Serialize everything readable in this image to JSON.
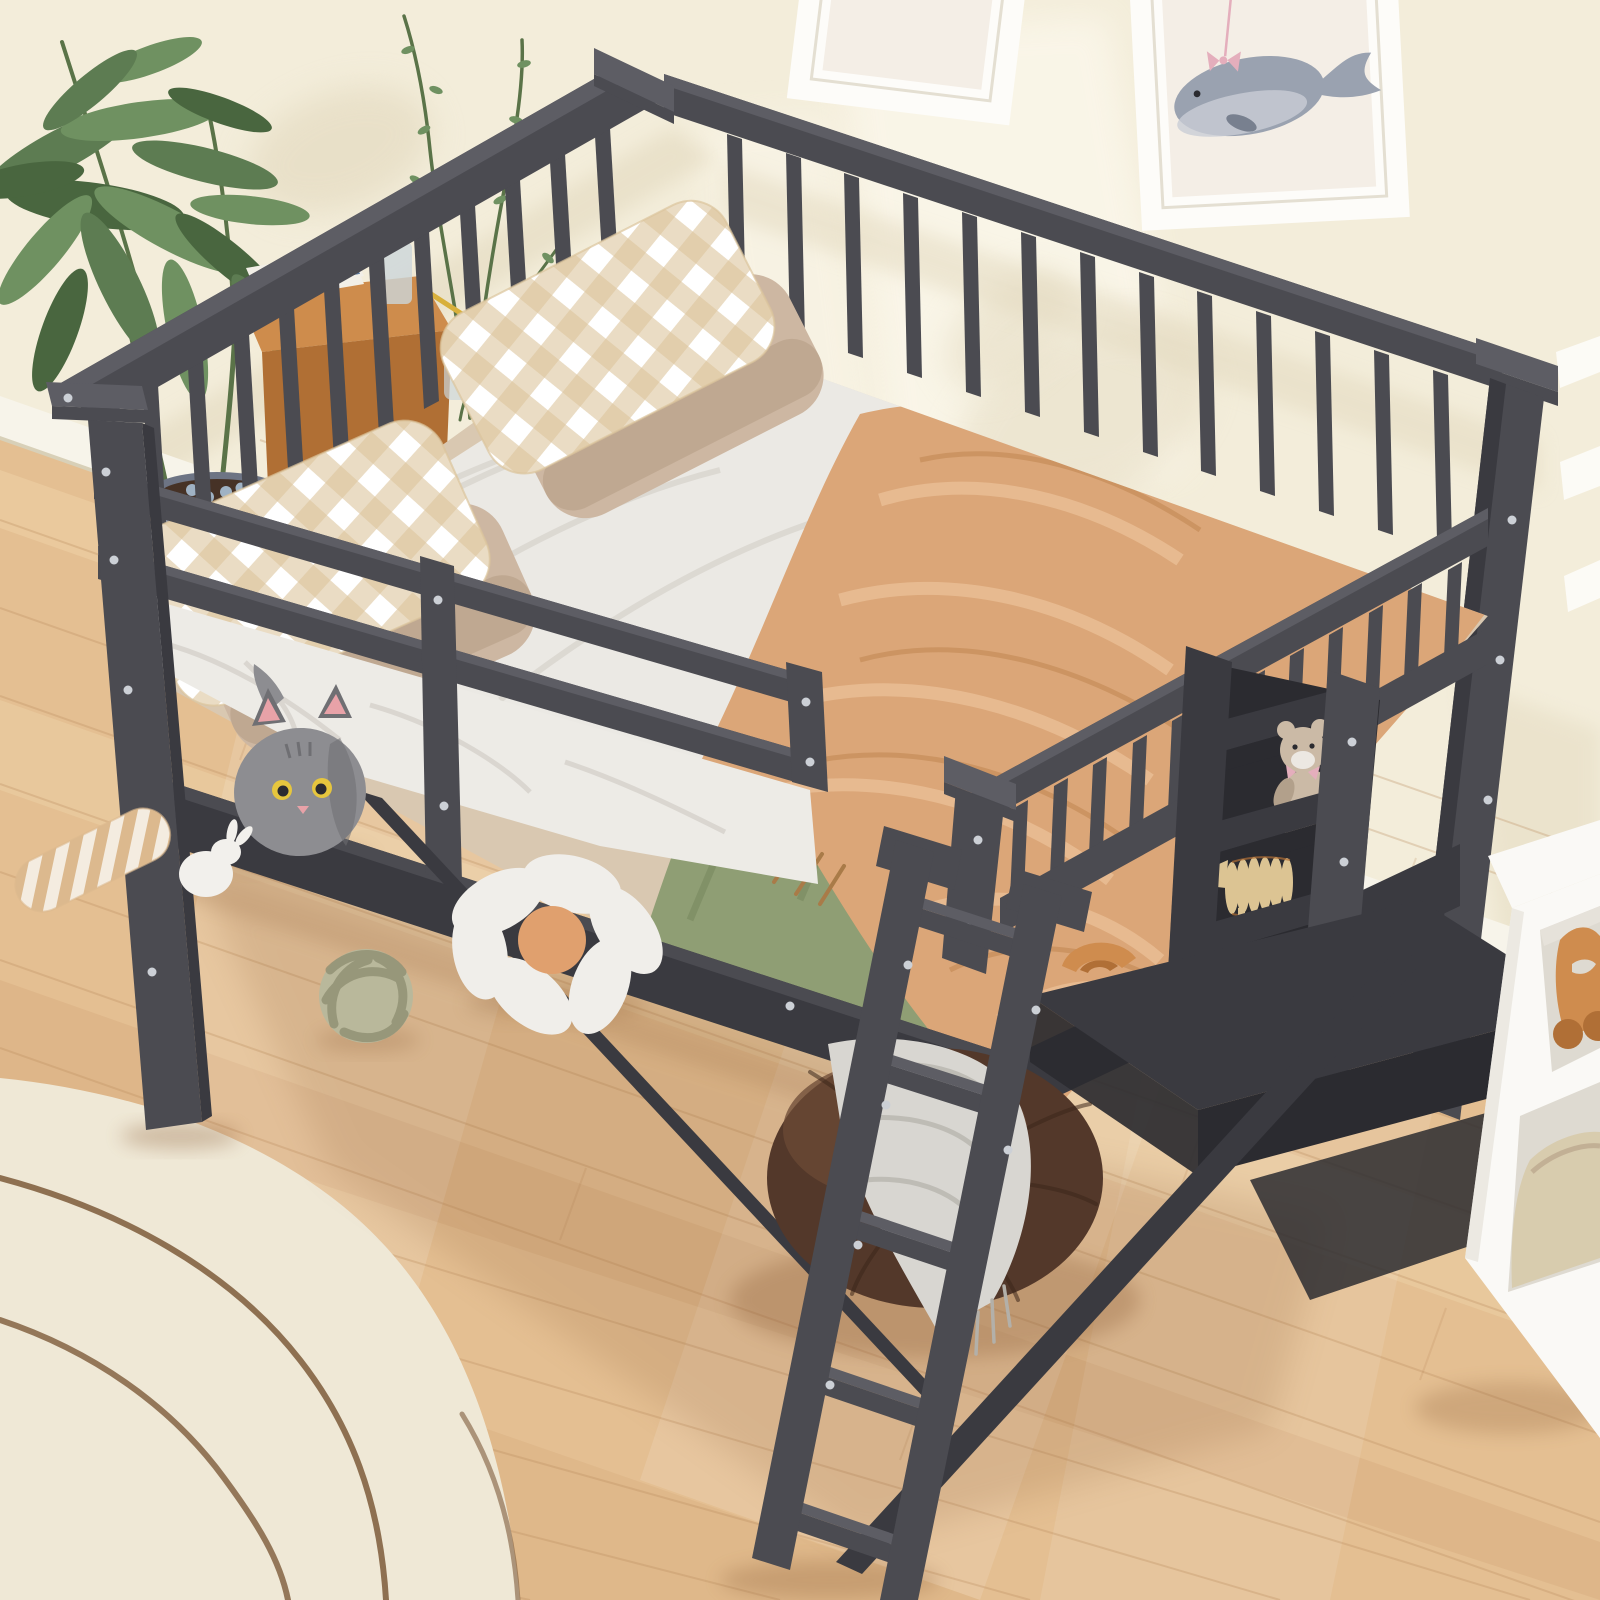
{
  "meta": {
    "title": "Product photo: gray wooden full-size loft bed with storage shelves, desk and ladder in a child's bedroom"
  },
  "palette": {
    "wall": "#f3edda",
    "wall_shadow": "#e2d8bd",
    "wall_light": "#fcf8ec",
    "baseboard": "#f7f4ea",
    "baseboard_shadow": "#d8d0b8",
    "floor": "#e4bf92",
    "floor_light": "#f2d9af",
    "floor_dark": "#cfa273",
    "floor_seam": "#b98a5c",
    "floor_shadow": "#8a5c34",
    "rug": "#efe8d6",
    "rug_line": "#7d5a3a",
    "frame_white": "#fdfcf9",
    "frame_shadow": "#e4dfd2",
    "frame_mat": "#f4eee6",
    "whale_gray": "#9aa2b0",
    "whale_dark": "#78808f",
    "whale_belly": "#c9cdd6",
    "bow_pink": "#e4aebc",
    "leaf_a": "#5d7c52",
    "leaf_b": "#6f9161",
    "leaf_c": "#49663f",
    "stem": "#5a7348",
    "pot": "#8b93a4",
    "pot_dark": "#6d7484",
    "soil": "#463226",
    "pebble": "#9fb2c4",
    "nightstand": "#ce8c4c",
    "nightstand_dark": "#b06f34",
    "book_white": "#f2efe7",
    "book_blue": "#5a7aa0",
    "glass": "#ccd6da",
    "pencil_yellow": "#d8b03c",
    "bed_mid": "#4b4b51",
    "bed_light": "#5d5d64",
    "bed_dark": "#3a3a40",
    "bed_darker": "#2b2b30",
    "screw": "#ccd0d6",
    "mattress_white": "#edebe6",
    "mattress_shadow": "#d5d1cb",
    "sheet_beige": "#d9c8b1",
    "sheet_white": "#ebe9e4",
    "green_sheet": "#8f9e74",
    "green_dark": "#77865d",
    "blanket": "#dba678",
    "blanket_light": "#eec49c",
    "blanket_dark": "#c28954",
    "fringe_brown": "#a97b48",
    "gingham_beige": "#dcc49c",
    "stripe_beige": "#dcb98e",
    "pillow_beige": "#cdb7a2",
    "pillow_beige_dark": "#b49c84",
    "cat_gray": "#8d8d91",
    "cat_dark": "#6f6f73",
    "cat_pink": "#e8a2a8",
    "cat_eye": "#e6c63e",
    "toy_white": "#f2f0ec",
    "knot": "#b9b89b",
    "knot_dark": "#8f8e72",
    "flower_white": "#f0eeea",
    "flower_center": "#e0a06e",
    "pouf": "#53382a",
    "pouf_light": "#6b4a36",
    "pouf_dark": "#3c2719",
    "throw": "#d8d6d1",
    "throw_dark": "#b3b0a9",
    "cube_white": "#faf9f6",
    "cube_shadow": "#e6e2da",
    "cube_open": "#dedad1",
    "wood_toy": "#cf8c4e",
    "wood_toy_dark": "#b06f36",
    "basket": "#d8ccae",
    "teddy": "#cbbaa6",
    "teddy_dark": "#b2a08b",
    "sheep_wood": "#dcc493"
  },
  "objects": {
    "scene": "Children's bedroom with a dark gray wooden full-size loft bed with guardrails, under-bed shelves, desk and ladder",
    "wall": "Cream painted wall with soft window light",
    "baseboard": "White baseboard trim",
    "wood_floor": "Light oak plank floor",
    "area_rug": "Cream area rug with brown wavy line pattern",
    "wall_art_left": "White picture frame, partially cropped at top of image",
    "wall_art_whale": "White framed watercolor whale print with pink bow",
    "wall_slats": "White wall trim pieces behind right bed post",
    "plant": "Tall potted green plant in blue-gray ceramic pot",
    "branches": "Decorative green sprig branches behind the head guardrail",
    "nightstand": "Small wooden nightstand with books, glass and pencil behind the bed",
    "loft_bed": "Dark gray wooden full-size loft bed frame",
    "head_guardrail": "Head-side top guardrail with vertical slats",
    "back_guardrail": "Long side top guardrail with vertical slats",
    "front_guardrail": "Front double-bar safety guardrail with center post",
    "foot_guardrail": "Foot-side slatted guardrail above the storage unit",
    "left_post": "Front-left bed post",
    "right_post": "Right corner bed post",
    "mattress": "Full-size mattress with white sheet",
    "bed_sheet_beige": "Beige knit sheet layer",
    "green_sheet": "Sage green fitted sheet",
    "orange_blanket": "Draped terracotta fleece blanket with fringe",
    "pillows": "Two sets of stacked pillows: beige-white gingham over solid beige",
    "ladder": "Slanted dark gray wooden ladder with five rungs",
    "storage_shelves": "Built-in dark gray under-bed storage shelves",
    "teddy_bear": "Small beige teddy bear with pink bow on shelf",
    "wooden_sheep_toy": "Wooden 3D-puzzle sheep toy on shelf",
    "wooden_arch_toy": "Small wooden arch toy on desk",
    "under_bed_desk": "Dark gray under-bed desk surface",
    "support_braces": "Diagonal support braces under the bed",
    "bean_pouf": "Round brown leather pouf under the ladder",
    "throw_blanket": "Light gray waffle throw with fringe draped over pouf",
    "plush_cat": "Round gray plush cat with yellow eyes and pink ears",
    "plush_bunny": "Small white plush bunny",
    "striped_toy": "Striped beige plush stick toy",
    "knot_ball": "Sage green knotted ball cushion",
    "flower_cushion": "White daisy flower cushion with orange center",
    "cube_shelf": "White cube storage unit with wooden animal toy and beige basket",
    "window_light": "Soft sunlight patch falling on wall and floor"
  }
}
